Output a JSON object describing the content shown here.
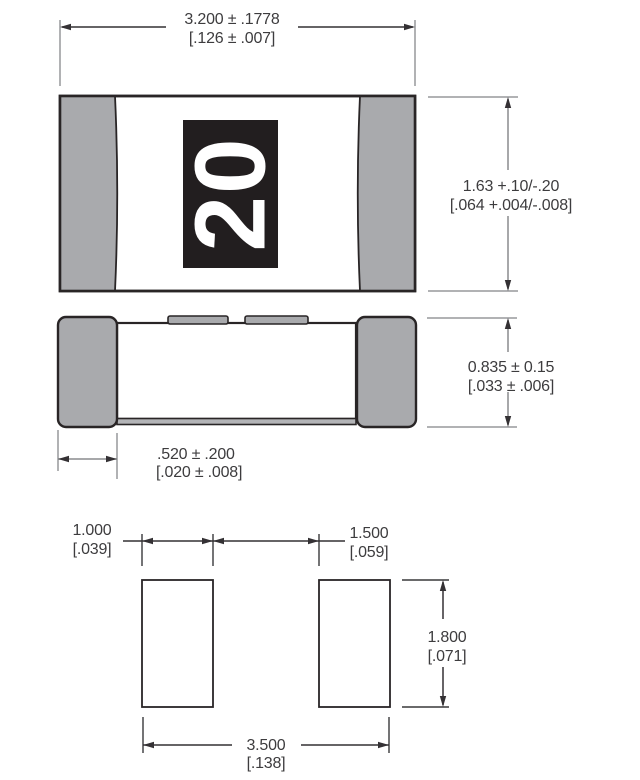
{
  "drawing": {
    "type": "chip-component-dimension-drawing",
    "marking": "20"
  },
  "top_view": {
    "marking": "20",
    "width_dim": {
      "line1": "3.200 ± .1778",
      "line2": "[.126 ± .007]"
    },
    "height_dim": {
      "line1": "1.63 +.10/-.20",
      "line2": "[.064 +.004/-.008]"
    }
  },
  "side_view": {
    "height_dim": {
      "line1": "0.835 ± 0.15",
      "line2": "[.033 ± .006]"
    },
    "terminal_dim": {
      "line1": ".520 ± .200",
      "line2": "[.020 ± .008]"
    }
  },
  "land_pattern": {
    "pad_width_dim": {
      "line1": "1.000",
      "line2": "[.039]"
    },
    "gap_dim": {
      "line1": "1.500",
      "line2": "[.059]"
    },
    "pad_height_dim": {
      "line1": "1.800",
      "line2": "[.071]"
    },
    "span_dim": {
      "line1": "3.500",
      "line2": "[.138]"
    }
  },
  "colors": {
    "background": "#ffffff",
    "terminal_gray": "#a9aaad",
    "bottom_strip_gray": "#b3b4b7",
    "outline_dark": "#292526",
    "marking_background": "#221e1f",
    "marking_text": "#ffffff",
    "dimension_line_dark": "#343134",
    "dimension_line_gray": "#8a8b8e",
    "extension_line_gray": "#97989b",
    "text_dark": "#3d3c3e"
  }
}
